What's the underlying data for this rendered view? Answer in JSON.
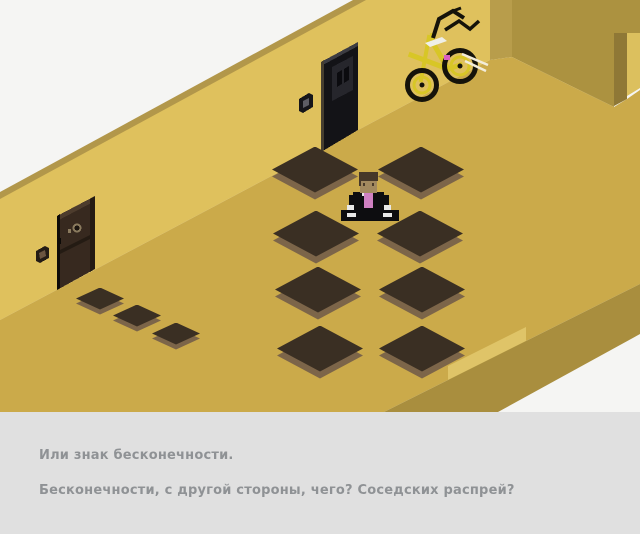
{
  "window": {
    "width": 640,
    "height": 534
  },
  "dialogue": {
    "lines": [
      "Или знак бесконечности.",
      "Бесконечности, с другой стороны, чего? Соседских распрей?"
    ]
  },
  "scene": {
    "objects": [
      "meditating character in black suit with pink shirt",
      "yellow bicycle leaning on wall corner",
      "dark brown door on left wall",
      "black door on back wall",
      "two diamond rings of dark floor tiles",
      "three small door mats",
      "wall switch beside each door"
    ],
    "tiles": {
      "large": [
        [
          315,
          173
        ],
        [
          421,
          173
        ],
        [
          316,
          237
        ],
        [
          420,
          237
        ],
        [
          318,
          293
        ],
        [
          422,
          293
        ],
        [
          320,
          352
        ],
        [
          422,
          352
        ]
      ],
      "mats": [
        [
          100,
          301
        ],
        [
          137,
          318
        ],
        [
          176,
          336
        ]
      ]
    },
    "colors": {
      "background": "#f5f5f3",
      "back_wall": "#dfc15d",
      "wall_top_edge": "#b2974a",
      "corner_edge": "#b89d4b",
      "right_wall": "#ac9240",
      "doorway_jamb": "#8f7836",
      "doorway_outer_wall": "#dcc05e",
      "floor": "#cbaa4a",
      "floor_side": "#a98e3e",
      "floor_edge_highlight": "#dfc468",
      "tile_top": "#3a2f23",
      "tile_side": "#7c6549",
      "left_door": "#37291f",
      "middle_door": "#131317",
      "bike_frame": "#d8c626",
      "shirt_pink": "#cf80c2",
      "panel_bg": "#e0e0e0",
      "panel_text": "#8f9295"
    }
  }
}
